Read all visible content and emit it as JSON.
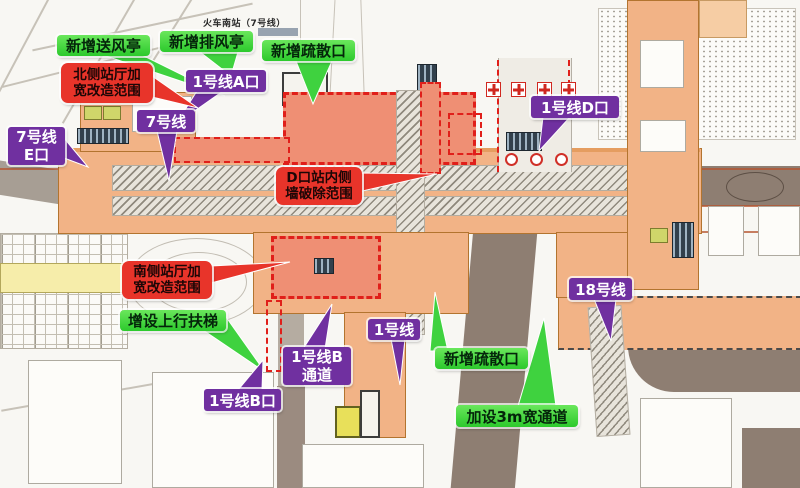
{
  "map": {
    "station_note": "火车南站（7号线）",
    "type": "metro-station-reconstruction-site-plan"
  },
  "colors": {
    "label_green": "#3fd23f",
    "label_purple": "#7030a0",
    "label_red": "#e8342a",
    "highlight_fill": "#ef8f74",
    "highlight_border": "#e01f1a",
    "building_orange": "#f2b386",
    "road_gray": "#a79e94",
    "road_brown": "#8e7e72",
    "platform_yellow": "#f6edaa"
  },
  "icons": {
    "exit_marker": "red-cross-marker",
    "escalator_block": "striped-dark-block"
  },
  "callouts": {
    "green": [
      {
        "id": "new-supply-vent",
        "text": "新增送风亭"
      },
      {
        "id": "new-exhaust-vent",
        "text": "新增排风亭"
      },
      {
        "id": "new-evac-exit-north",
        "text": "新增疏散口"
      },
      {
        "id": "new-up-escalator",
        "text": "增设上行扶梯"
      },
      {
        "id": "new-evac-exit-south",
        "text": "新增疏散口"
      },
      {
        "id": "new-3m-passage",
        "text": "加设3m宽通道"
      }
    ],
    "purple": [
      {
        "id": "line1-exit-a",
        "text": "1号线A口"
      },
      {
        "id": "line7",
        "text": "7号线"
      },
      {
        "id": "line7-exit-e",
        "lines": [
          "7号线",
          "E口"
        ]
      },
      {
        "id": "line1-exit-d",
        "text": "1号线D口"
      },
      {
        "id": "line18",
        "text": "18号线"
      },
      {
        "id": "line1",
        "text": "1号线"
      },
      {
        "id": "line1-passage-b",
        "lines": [
          "1号线B",
          "通道"
        ]
      },
      {
        "id": "line1-exit-b",
        "text": "1号线B口"
      }
    ],
    "red": [
      {
        "id": "north-hall-widening",
        "lines": [
          "北侧站厅加",
          "宽改造范围"
        ]
      },
      {
        "id": "d-exit-wall-demolition",
        "lines": [
          "D口站内侧",
          "墙破除范围"
        ]
      },
      {
        "id": "south-hall-widening",
        "lines": [
          "南侧站厅加",
          "宽改造范围"
        ]
      }
    ]
  }
}
